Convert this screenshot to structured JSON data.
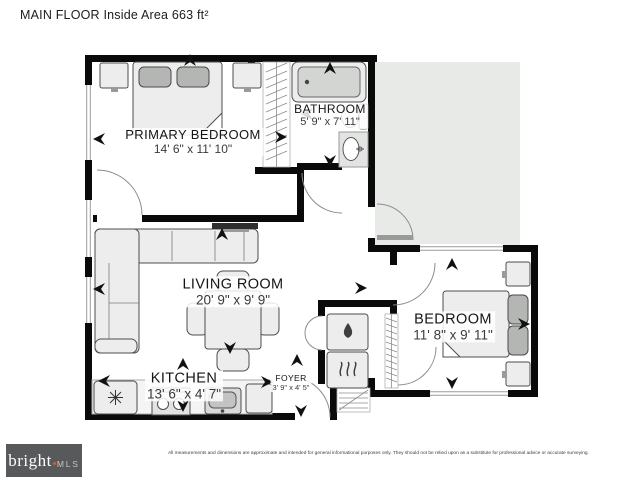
{
  "title": "MAIN FLOOR Inside Area 663 ft²",
  "rooms": {
    "primary_bedroom": {
      "name": "PRIMARY BEDROOM",
      "dims": "14' 6\" x 11' 10\""
    },
    "bathroom": {
      "name": "BATHROOM",
      "dims": "5' 9\" x 7' 11\""
    },
    "living_room": {
      "name": "LIVING ROOM",
      "dims": "20' 9\" x 9' 9\""
    },
    "kitchen": {
      "name": "KITCHEN",
      "dims": "13' 6\" x 4' 7\""
    },
    "foyer": {
      "name": "FOYER",
      "dims": "3' 9\" x 4' 5\""
    },
    "bedroom": {
      "name": "BEDROOM",
      "dims": "11' 8\" x 9' 11\""
    }
  },
  "footer": {
    "brand": "bright",
    "brand_suffix": "MLS",
    "disclaimer": "All measurements and dimensions are approximate and intended for general informational purposes only. They should not be relied upon as a substitute for professional advice or accurate surveying."
  },
  "icons": {
    "refrigerator": "snowflake-icon",
    "washer": "water-drop-icon",
    "dryer": "heat-waves-icon",
    "door_swings": "door-arc",
    "direction_markers": "arrow-icon"
  },
  "colors": {
    "wall": "#0a0a0a",
    "furniture_fill": "#ededed",
    "furniture_stroke": "#4d4d4d",
    "pillow_fill": "#b4b6b4",
    "deck_fill": "#e8eae8",
    "logo_bg": "#58595b",
    "logo_accent": "#e8542e"
  }
}
